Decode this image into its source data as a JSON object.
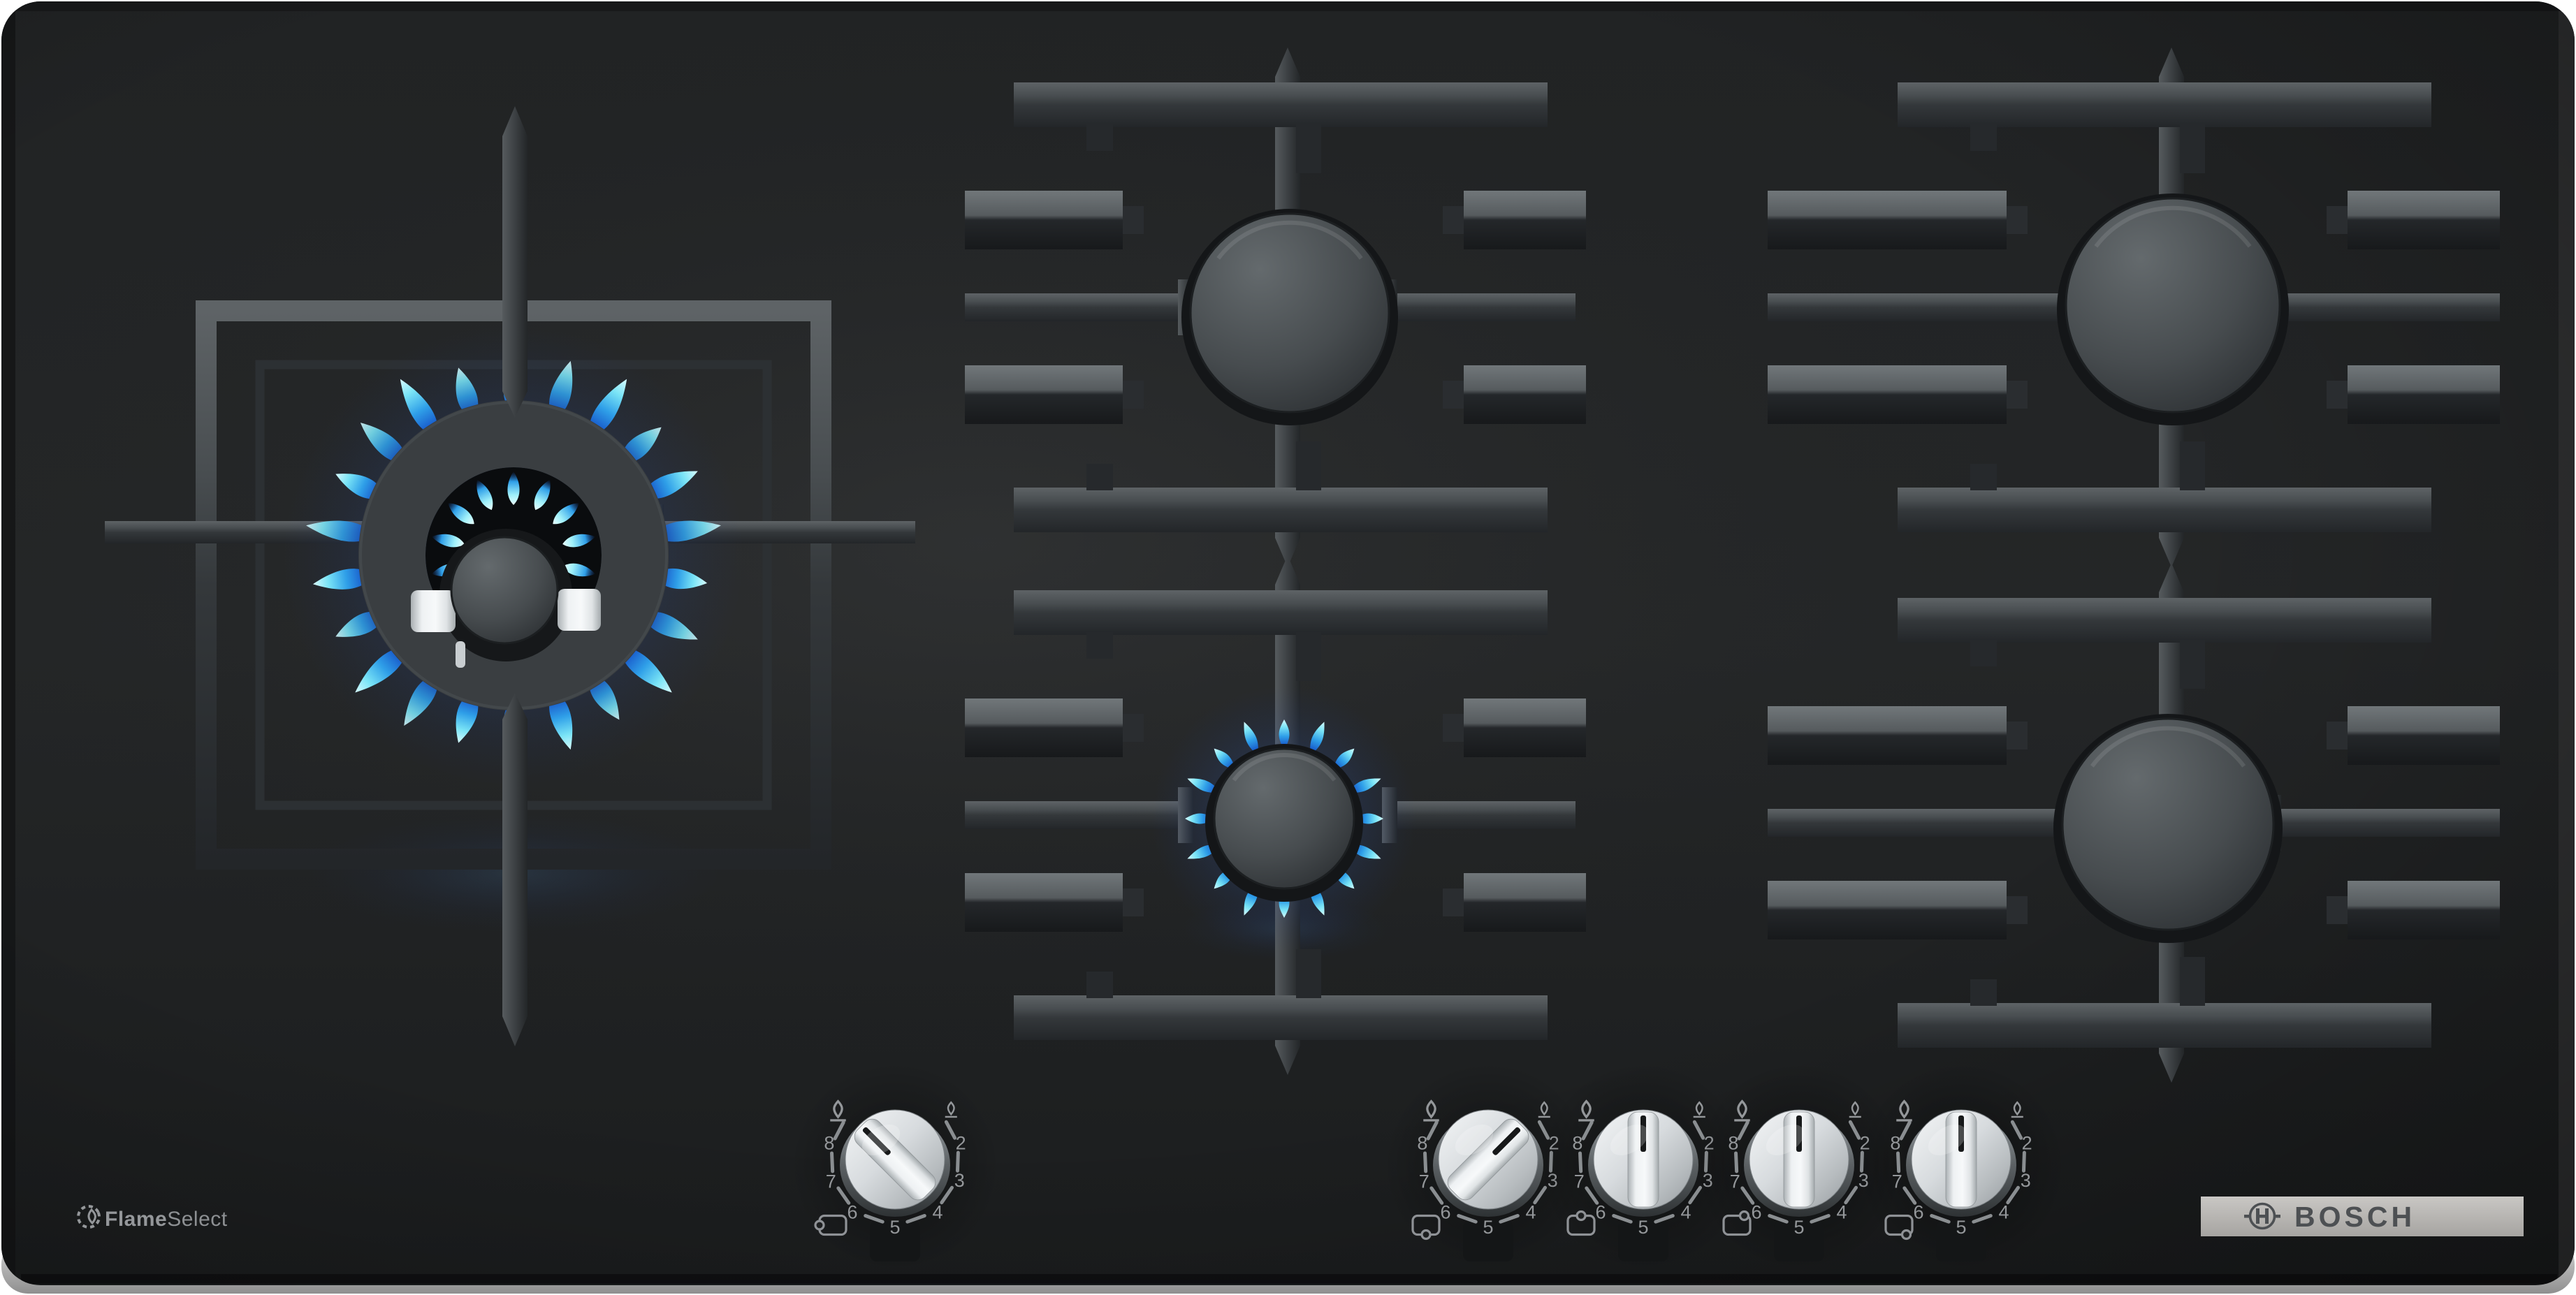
{
  "product": {
    "name": "5-burner gas hob on black glass",
    "burner_count": 5,
    "lit_burners": 2
  },
  "branding": {
    "flameselect": {
      "bold": "Flame",
      "regular": "Select",
      "icon": "flame-in-dashed-circle-icon"
    },
    "bosch_wordmark": "BOSCH",
    "bosch_icon": "bosch-circle-h-anchor-icon"
  },
  "knob_scale": {
    "numbers": [
      "8",
      "7",
      "6",
      "5",
      "4",
      "3",
      "2"
    ],
    "max_flame_icon": "large-flame-icon",
    "min_flame_icon": "small-flame-icon"
  },
  "knobs": [
    {
      "id": "knob-left-wok",
      "burner": "left-wok",
      "position_icon": "circle-left",
      "state": "on-high",
      "setting": "max",
      "pointer_angle_deg": -45
    },
    {
      "id": "knob-front-center",
      "burner": "front-center",
      "position_icon": "circle-bottom-center",
      "state": "on-simmer",
      "setting": "min",
      "pointer_angle_deg": 45
    },
    {
      "id": "knob-rear-center",
      "burner": "rear-center",
      "position_icon": "circle-top-center",
      "state": "off",
      "setting": "off",
      "pointer_angle_deg": 0
    },
    {
      "id": "knob-rear-right",
      "burner": "rear-right",
      "position_icon": "circle-top-right",
      "state": "off",
      "setting": "off",
      "pointer_angle_deg": 0
    },
    {
      "id": "knob-front-right",
      "burner": "front-right",
      "position_icon": "circle-bottom-right",
      "state": "off",
      "setting": "off",
      "pointer_angle_deg": 0
    }
  ],
  "burners": [
    {
      "id": "left-wok",
      "type": "dual-ring-wok",
      "state": "lit-high",
      "flame_color": "blue"
    },
    {
      "id": "rear-center",
      "type": "standard",
      "state": "off",
      "flame_color": null
    },
    {
      "id": "front-center",
      "type": "economy",
      "state": "lit-simmer",
      "flame_color": "blue"
    },
    {
      "id": "rear-right",
      "type": "high-power",
      "state": "off",
      "flame_color": null
    },
    {
      "id": "front-right",
      "type": "high-power",
      "state": "off",
      "flame_color": null
    }
  ],
  "colors": {
    "glass": "#222425",
    "grate": "#3a3e41",
    "flame_deep_blue": "#1756c9",
    "flame_blue": "#2f9fe8",
    "flame_cyan": "#9ff0fa",
    "knob_silver": "#d7dbde",
    "bosch_bar_silver": "#b5b3b0",
    "bosch_text_gray": "#4d5053",
    "print_gray": "#94979a"
  }
}
